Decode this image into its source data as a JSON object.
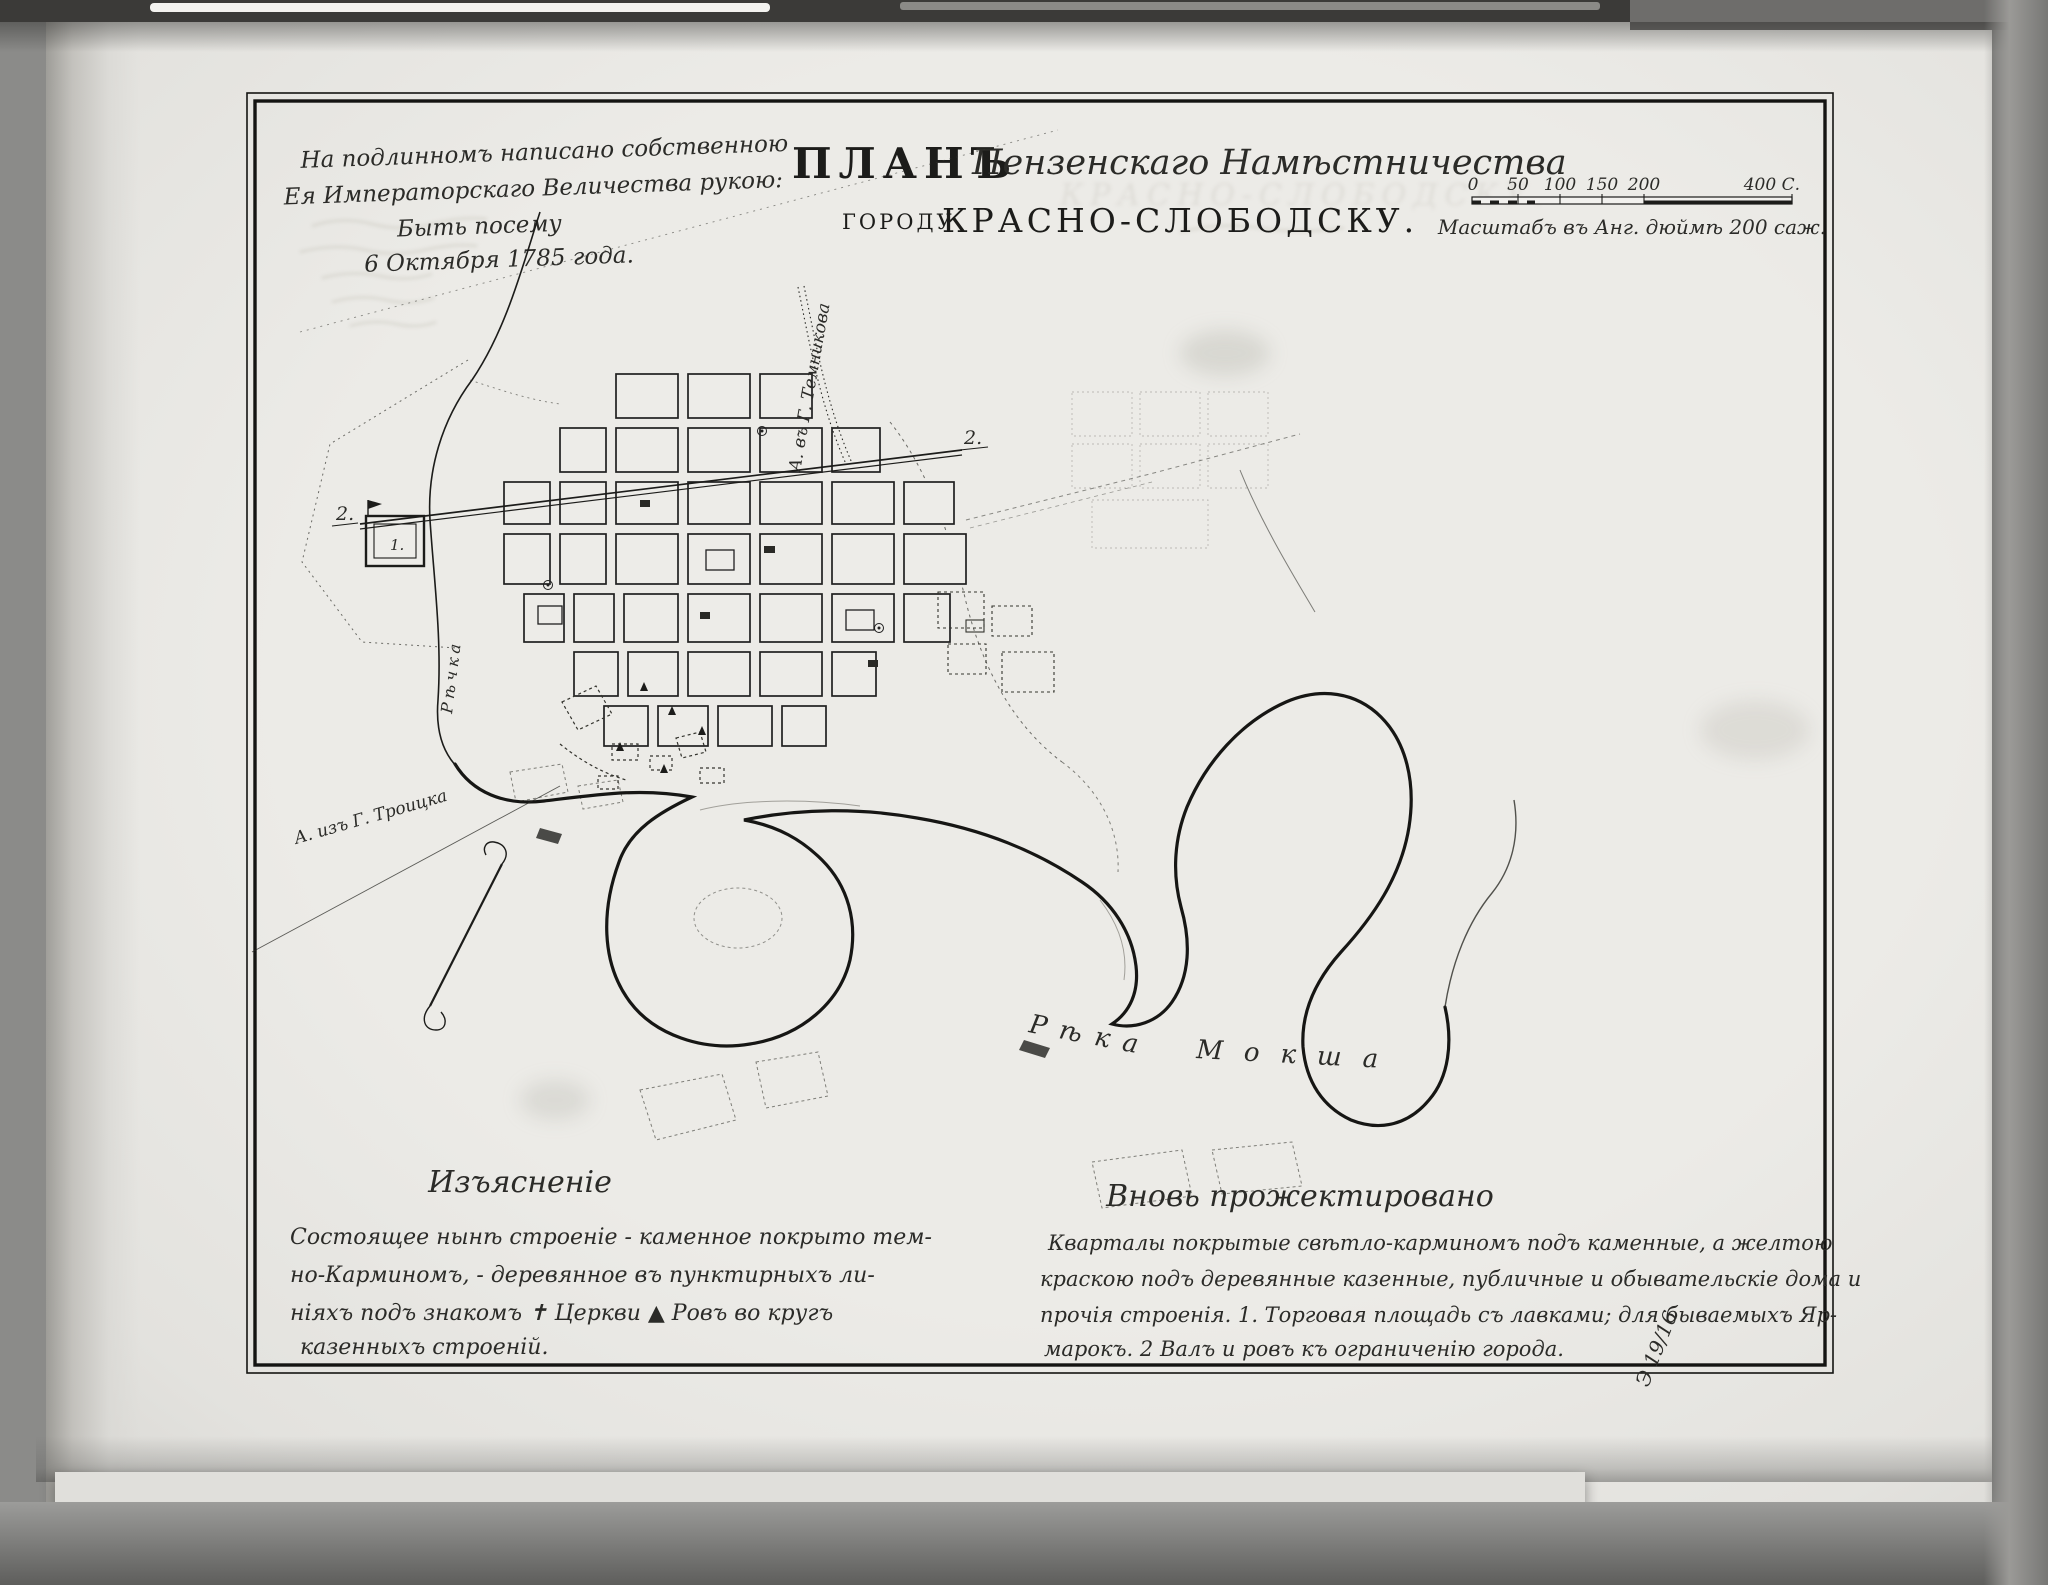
{
  "title": {
    "word_plan": "ПЛАНЪ",
    "region_script": "Пензенскаго Намѣстничества",
    "city_prefix": "ГОРОДУ",
    "city_name": "КРАСНО-СЛОБОДСКУ."
  },
  "imperial_note": {
    "lines": [
      "На подлинномъ написано собственною",
      "Ея Императорскаго Величества рукою:",
      "Быть посему",
      "6 Октября 1785 года."
    ]
  },
  "scale": {
    "ticks": [
      "0",
      "50",
      "100",
      "150",
      "200"
    ],
    "end_label": "400 С.",
    "caption": "Масштабъ въ Анг. дюймѣ 200 саж."
  },
  "legend_left": {
    "heading": "Изъясненіе",
    "lines": [
      "Состоящее нынѣ строеніе - каменное покрыто тем-",
      "но-Карминомъ, - деревянное въ пунктирныхъ ли-",
      "ніяхъ подъ знакомъ ✝ Церкви ▲ Ровъ во кругъ",
      "казенныхъ строеній."
    ]
  },
  "legend_right": {
    "heading": "Вновь прожектировано",
    "lines": [
      "Кварталы покрытые свѣтло-карминомъ подъ каменные, а желтою",
      "краскою подъ деревянные казенные, публичные и обывательскіе дома и",
      "прочія строенія. 1. Торговая площадь съ лавками; для бываемыхъ Яр-",
      "марокъ. 2 Валъ и ровъ къ ограниченію города."
    ]
  },
  "map_labels": {
    "river_main_word1": "Рѣка",
    "river_main_word2": "Мокша",
    "river_small": "Рѣчка",
    "road_temnikov": "А. въ Г. Темникова",
    "road_troitsk": "А. изъ Г. Троицка",
    "fortress_marker": "1.",
    "rampart_marker_west": "2.",
    "rampart_marker_east": "2."
  },
  "annotations": {
    "corner_mark": "Э 19/16"
  },
  "colors": {
    "paper": "#ecebe7",
    "ink": "#1c1c1a",
    "ghost": "#c6c4bb"
  }
}
